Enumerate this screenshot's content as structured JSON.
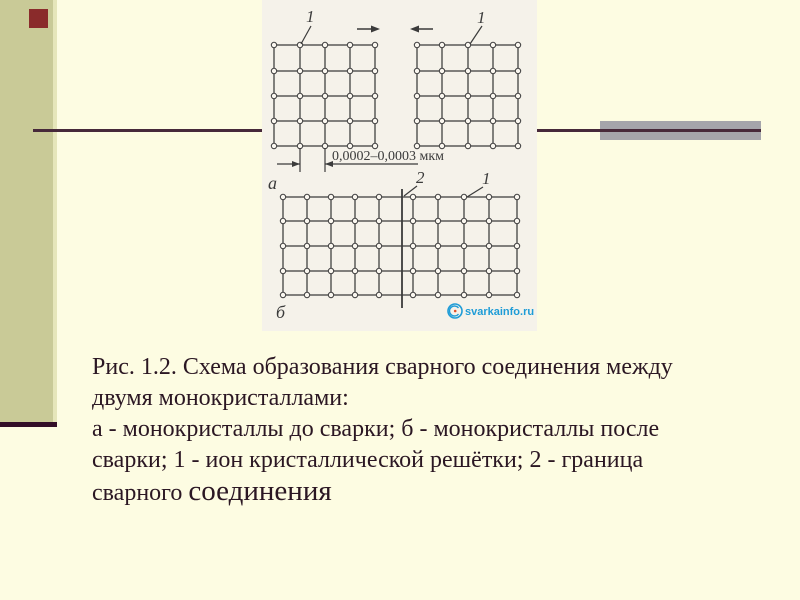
{
  "slide": {
    "type": "presentation-slide"
  },
  "colors": {
    "background": "#fdfce2",
    "sidebar_band": "#c9ca97",
    "band_edge": "#e6e6ba",
    "bullet_square": "#8a2b2b",
    "rule_line": "#47293a",
    "gray_bar": "#a5a5ab",
    "bottom_bar": "#330e27",
    "caption_text": "#2b1723",
    "figure_background": "#f5f2ea",
    "figure_ink": "#3b3b3b",
    "watermark_blue": "#1e9cd7",
    "watermark_red": "#e0512a"
  },
  "figure": {
    "label_ion_top_left": "1",
    "label_ion_top_right": "1",
    "label_before_welding": "а",
    "label_after_welding": "б",
    "label_boundary": "2",
    "label_ion_bottom": "1",
    "dimension_text": "0,0002–0,0003 мкм",
    "watermark_text": "svarkainfo.ru",
    "lattices": [
      {
        "name": "monocrystal-top-left",
        "cols": [
          12,
          38,
          63,
          88,
          113
        ],
        "rows": [
          45,
          71,
          96,
          121,
          146
        ]
      },
      {
        "name": "monocrystal-top-right",
        "cols": [
          155,
          180,
          206,
          231,
          256
        ],
        "rows": [
          45,
          71,
          96,
          121,
          146
        ]
      },
      {
        "name": "monocrystals-welded-bottom",
        "cols": [
          21,
          45,
          69,
          93,
          117,
          151,
          176,
          202,
          227,
          255
        ],
        "rows": [
          197,
          221,
          246,
          271,
          295
        ]
      }
    ]
  },
  "caption": {
    "lines": [
      "Рис. 1.2. Схема образования сварного соединения между",
      "двумя монокристаллами:",
      "а - монокристаллы до сварки; б - монокристаллы после",
      "сварки; 1 - ион кристаллической решётки; 2 - граница"
    ],
    "line5_start": "сварного ",
    "line5_emphasis": "соединения"
  }
}
